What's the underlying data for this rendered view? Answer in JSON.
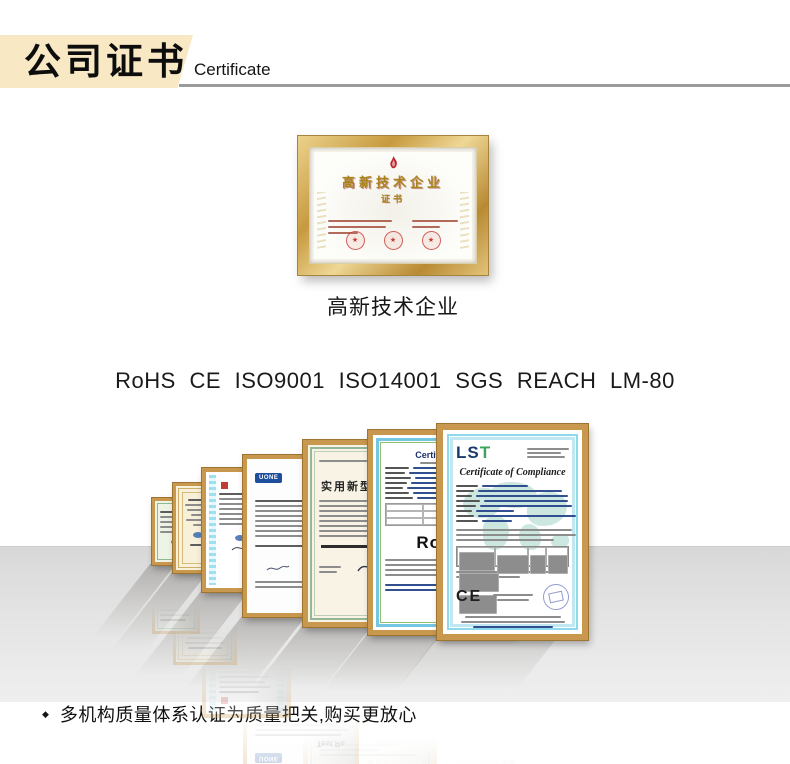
{
  "header": {
    "title_cn": "公司证书",
    "title_en": "Certificate"
  },
  "featured_plaque": {
    "title": "高新技术企业",
    "subtitle": "证书",
    "caption": "高新技术企业"
  },
  "standards_line": "RoHS CE ISO9001 ISO14001 SGS REACH LM-80",
  "certificates": {
    "uone": {
      "badge": "UONE",
      "title": "Test Re"
    },
    "patent": {
      "title": "实用新型"
    },
    "rohs": {
      "header": "Certification",
      "big_text": "RoHS"
    },
    "lst": {
      "logo_ls": "LS",
      "logo_t": "T",
      "title": "Certificate of Compliance",
      "ce_mark": "CE"
    }
  },
  "footer": {
    "bullet": "◆",
    "note": "多机构质量体系认证为质量把关,购买更放心"
  },
  "colors": {
    "banner_beige": "#f8e8c4",
    "frame_gold": "#c9984f",
    "accent_red": "#c0272d",
    "navy": "#1b3b6f",
    "green": "#3aa55a",
    "floor_gray": "#d8d8d8"
  }
}
